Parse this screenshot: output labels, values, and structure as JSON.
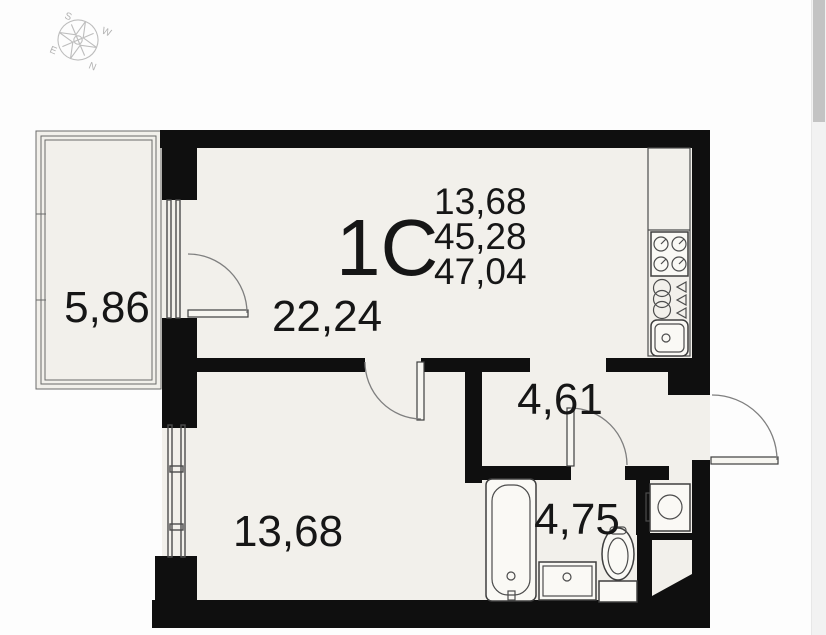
{
  "plan": {
    "code": "1С",
    "area_lines": [
      "13,68",
      "45,28",
      "47,04"
    ],
    "rooms": {
      "balcony": "5,86",
      "living_kitchen": "22,24",
      "bedroom": "13,68",
      "hallway": "4,61",
      "bathroom": "4,75"
    },
    "colors": {
      "wall": "#0f0f0f",
      "floor": "#f2f0eb",
      "outline": "#4c4c4c",
      "door_arc": "#7f7f7f",
      "compass": "#bdbdbd",
      "text": "#161616"
    }
  },
  "compass": {
    "n": "N",
    "s": "S",
    "e": "E",
    "w": "W"
  },
  "scrollbar": {
    "track_color": "#f2f2f2",
    "thumb_color": "#c3c3c3"
  }
}
